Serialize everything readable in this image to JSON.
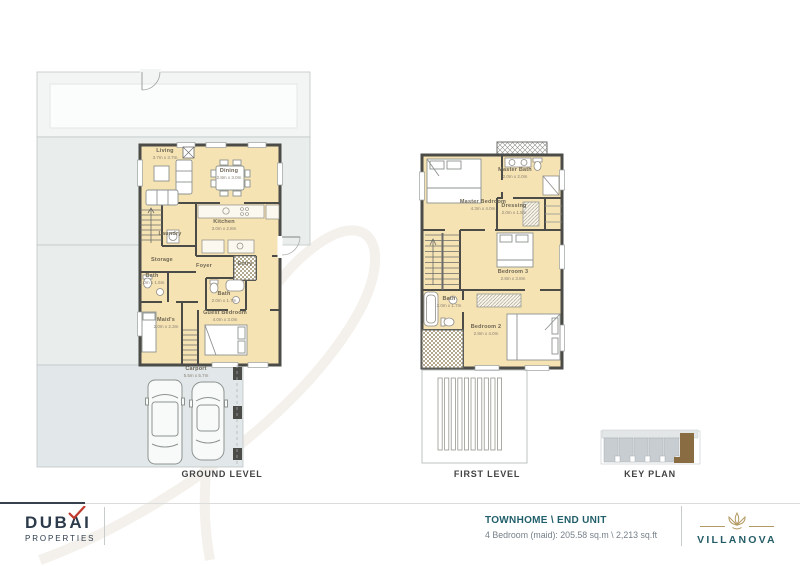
{
  "plans": {
    "ground": {
      "caption": "GROUND LEVEL",
      "rooms": {
        "living": {
          "name": "Living",
          "dims": "3.7m x 3.7m"
        },
        "dining": {
          "name": "Dining",
          "dims": "2.8m x 3.0m"
        },
        "kitchen": {
          "name": "Kitchen",
          "dims": "3.0m x 2.8m"
        },
        "laundry": {
          "name": "Laundry"
        },
        "storage": {
          "name": "Storage"
        },
        "foyer": {
          "name": "Foyer"
        },
        "entry": {
          "name": "Entry"
        },
        "powder": {
          "name": "Bath",
          "dims": "2.0m x 1.5m"
        },
        "bath": {
          "name": "Bath",
          "dims": "2.0m x 1.7m"
        },
        "maids": {
          "name": "Maid's",
          "dims": "2.0m x 2.3m"
        },
        "guest": {
          "name": "Guest Bedroom",
          "dims": "4.0m x 3.0m"
        },
        "carport": {
          "name": "Carport",
          "dims": "5.5m x 5.7m"
        }
      }
    },
    "first": {
      "caption": "FIRST LEVEL",
      "rooms": {
        "master": {
          "name": "Master Bedroom",
          "dims": "4.3m x 4.0m"
        },
        "masterbath": {
          "name": "Master Bath",
          "dims": "2.0m x 2.0m"
        },
        "dressing": {
          "name": "Dressing",
          "dims": "2.0m x 1.5m"
        },
        "bedroom3": {
          "name": "Bedroom 3",
          "dims": "2.8m x 3.8m"
        },
        "bath": {
          "name": "Bath",
          "dims": "2.0m x 1.7m"
        },
        "bedroom2": {
          "name": "Bedroom 2",
          "dims": "2.8m x 4.0m"
        }
      }
    },
    "keyplan": {
      "caption": "KEY PLAN"
    }
  },
  "footer": {
    "brand": {
      "name": "DUBAI",
      "sub": "PROPERTIES"
    },
    "unit_title": "TOWNHOME \\ END UNIT",
    "unit_specs": "4 Bedroom (maid): 205.58 sq.m \\ 2,213 sq.ft",
    "development": "VILLANOVA"
  },
  "colors": {
    "accent_teal": "#215f6b",
    "brand_navy": "#2c3b4b",
    "brand_red": "#c2392e",
    "gold": "#b49a63",
    "room_fill": "#f5e3b4",
    "wall": "#4b4b47",
    "garden": "#e9edec",
    "carport": "#e2e8ea",
    "end_unit_brown": "#8a6c42"
  }
}
